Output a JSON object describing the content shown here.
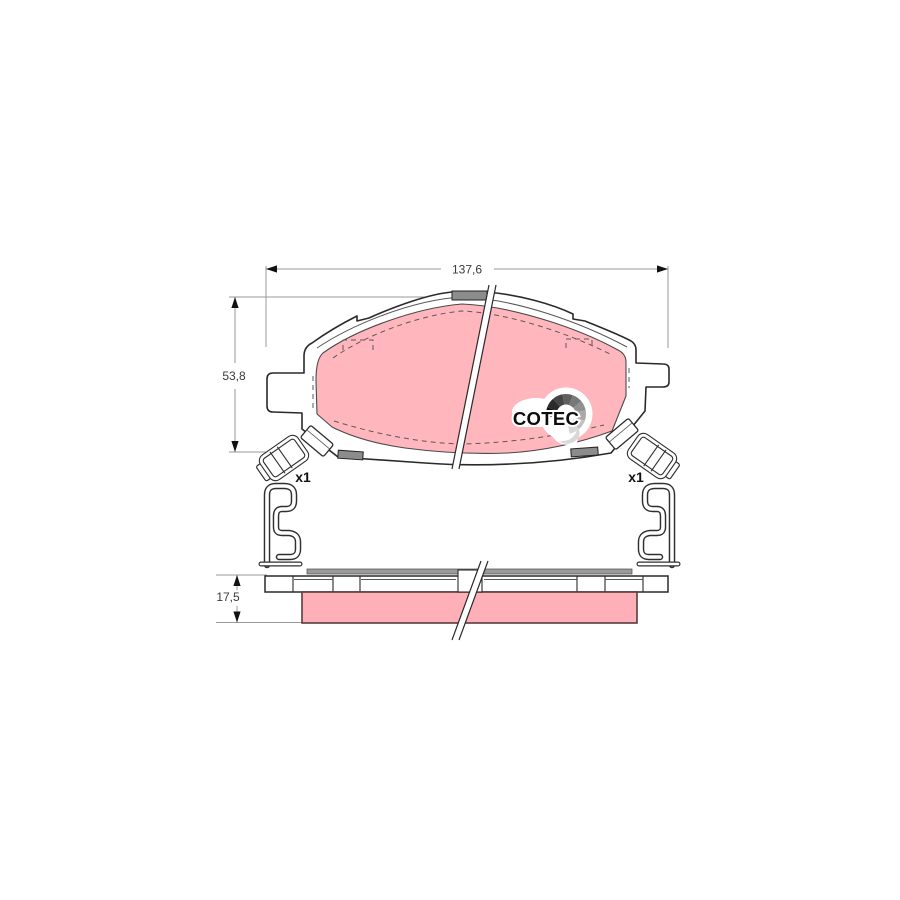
{
  "page": {
    "background": "#ffffff"
  },
  "logo": {
    "text": "COTEC",
    "fan_colors": [
      "#0f0f0f",
      "#2b2b2b",
      "#454545",
      "#5f5f5f",
      "#787878",
      "#919191",
      "#a9a9a9",
      "#c1c1c1",
      "#d8d8d8"
    ]
  },
  "dimensions": {
    "width_label": "137,6",
    "height_label": "53,8",
    "thickness_label": "17,5"
  },
  "quantities": {
    "left_clip_label": "x1",
    "right_clip_label": "x1"
  },
  "colors": {
    "friction_face": "#ffb6bd",
    "friction_edge": "#ffafb7",
    "friction_border": "#5a3c3c",
    "backing_outline": "#2a2a2a",
    "tab_gray": "#8c8c8c",
    "shim_gray": "#9a9a9a",
    "dim_line": "#9a9a9a"
  }
}
